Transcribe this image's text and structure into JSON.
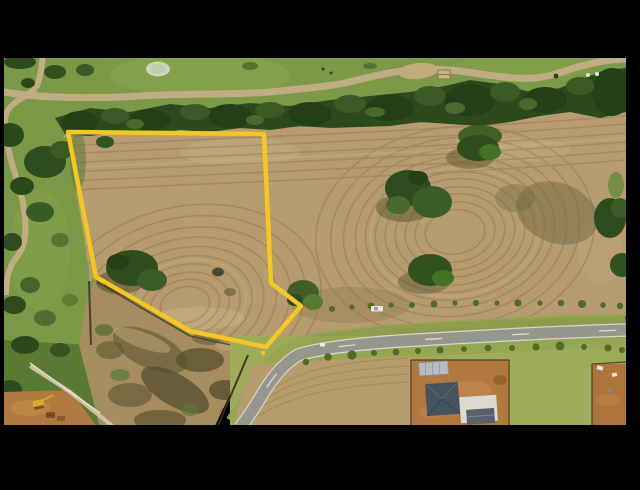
{
  "scene": {
    "type": "aerial-drone-photo-of-land-parcel",
    "boundary_points": "68,132 264,134 271,283 301,306 266,347 190,331 96,277",
    "colors": {
      "letterbox": "#000000",
      "boundary_yellow": "#f5c724",
      "field_tan": "#b69c6e",
      "mow_line_brown": "#8b6f45",
      "parkland_green": "#7c9947",
      "tree_green": "#2d4a1d",
      "path_tan": "#c0ad83",
      "road_gray": "#98978f",
      "road_marking_white": "#dcdcd6",
      "verge_green": "#96a551",
      "scrub_tan": "#a68d60",
      "dirt_orange": "#b1783f",
      "roof_dark_gray": "#46525e",
      "shed_light_gray": "#b7bdbf",
      "building_white": "#dbd9d2",
      "excavator_yellow": "#d9a92c"
    }
  }
}
